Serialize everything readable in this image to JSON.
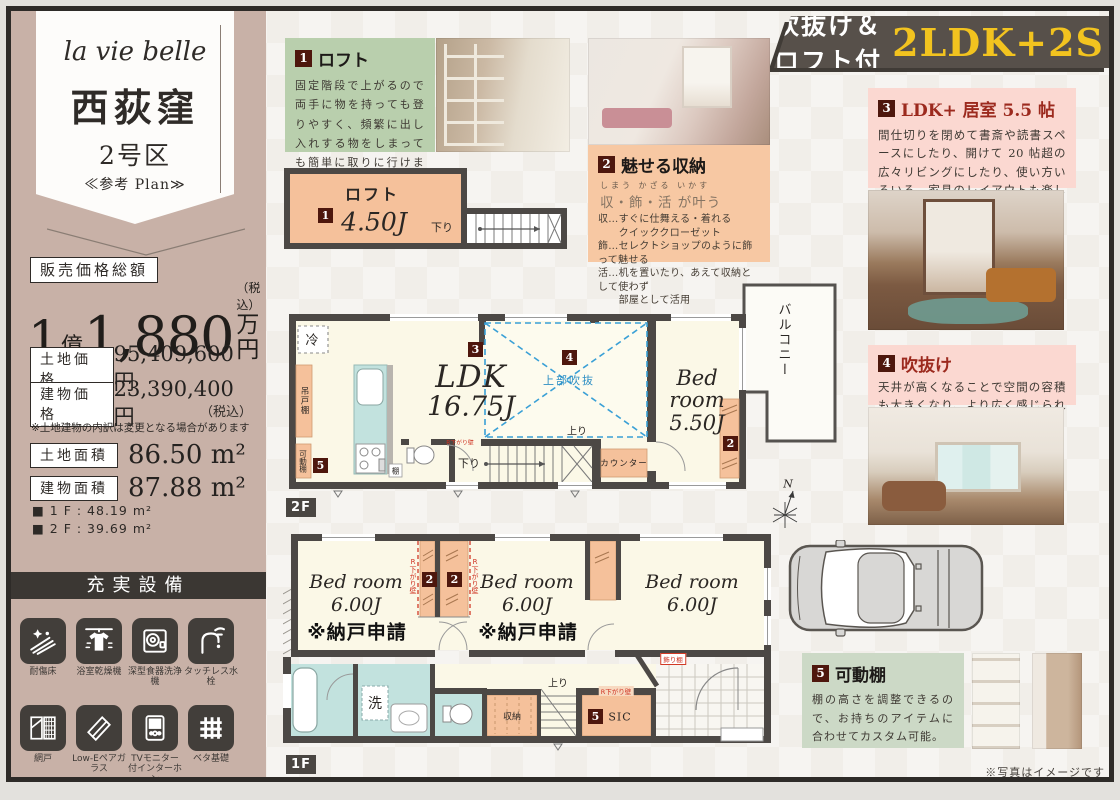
{
  "frame": {
    "disclaimer": "※写真はイメージです"
  },
  "banner": {
    "prefix": "吹抜け＆ロフト付",
    "plan_type": "2LDK+2S"
  },
  "sidebar": {
    "brand": "la vie belle",
    "name": "西荻窪",
    "lot": "2号区",
    "plan_ref": "≪参考 Plan≫",
    "price_label": "販売価格総額",
    "price": {
      "n1": "1",
      "u1": "億",
      "n2": "1,880",
      "tax": "（税込）",
      "u2": "万円"
    },
    "rows": [
      {
        "label": "土地価格",
        "value": "95,409,600 円"
      },
      {
        "label": "建物価格",
        "value": "23,390,400 円",
        "note": "（税込）"
      }
    ],
    "note": "※土地建物の内訳は変更となる場合があります",
    "areas": [
      {
        "label": "土地面積",
        "value": "86.50 m²"
      },
      {
        "label": "建物面積",
        "value": "87.88 m²"
      }
    ],
    "floors": [
      "■ 1 F : 48.19 m²",
      "■ 2 F : 39.69 m²"
    ],
    "equipment_title": "充実設備",
    "equipment": [
      {
        "label": "耐傷床",
        "icon": "scratch-resistant-floor"
      },
      {
        "label": "浴室乾燥機",
        "icon": "bathroom-dryer"
      },
      {
        "label": "深型食器洗浄機",
        "icon": "deep-dishwasher"
      },
      {
        "label": "タッチレス水栓",
        "icon": "touchless-faucet"
      },
      {
        "label": "網戸",
        "icon": "screen-door"
      },
      {
        "label": "Low-Eペアガラス",
        "icon": "low-e-pair-glass"
      },
      {
        "label": "TVモニター付インターホン",
        "icon": "tv-monitor-intercom"
      },
      {
        "label": "ベタ基礎",
        "icon": "slab-foundation"
      }
    ]
  },
  "features": {
    "f1": {
      "num": "1",
      "title": "ロフト",
      "body": "固定階段で上がるので両手に物を持っても登りやすく、頻繁に出し入れする物をしまっても簡単に取りに行けます。"
    },
    "f2": {
      "num": "2",
      "title": "魅せる収納",
      "ruby": "しまう かざる いかす",
      "sub": "収・飾・活 が叶う",
      "lines": [
        "収…すぐに仕舞える・着れる",
        "　　クイッククローゼット",
        "飾…セレクトショップのように飾って魅せる",
        "活…机を置いたり、あえて収納として使わず",
        "　　部屋として活用"
      ]
    },
    "f3": {
      "num": "3",
      "title": "LDK+ 居室 5.5 帖",
      "body": "間仕切りを閉めて書斎や読書スペースにしたり、開けて 20 帖超の広々リビングにしたり、使い方いろいろ。家具のレイアウトも楽しみの一つです。"
    },
    "f4": {
      "num": "4",
      "title": "吹抜け",
      "body": "天井が高くなることで空間の容積も大きくなり、より広く感じられます。"
    },
    "f5": {
      "num": "5",
      "title": "可動棚",
      "body": "棚の高さを調整できるので、お持ちのアイテムに合わせてカスタム可能。"
    }
  },
  "plans": {
    "loft": {
      "badge": "1",
      "name": "ロフト",
      "size": "4.50J",
      "down": "下り"
    },
    "f2": {
      "tag": "2F",
      "badge2": "2",
      "badge3": "3",
      "badge4": "4",
      "badge5": "5",
      "ldk": "LDK",
      "ldk_size": "16.75J",
      "void": "上部吹抜",
      "fridge": "冷",
      "hang_shelf": "吊戸棚",
      "mov_shelf": "可動棚",
      "shelf": "棚",
      "counter": "カウンター",
      "up": "上り",
      "down": "下り",
      "rwall": "R下がり壁",
      "bed_l1": "Bed",
      "bed_l2": "room",
      "bed_size": "5.50J",
      "balcony": "バルコニー"
    },
    "f1": {
      "tag": "1F",
      "badge2a": "2",
      "badge2b": "2",
      "badge5": "5",
      "bed1": "Bed room",
      "bed1_size": "6.00J",
      "bed1_note": "※納戸申請",
      "bed2": "Bed room",
      "bed2_size": "6.00J",
      "bed2_note": "※納戸申請",
      "bed3": "Bed room",
      "bed3_size": "6.00J",
      "rwall_left": "R下がり壁",
      "rwall_right": "R下がり壁",
      "rwall_sic": "R下がり壁",
      "wash": "洗",
      "storage": "収納",
      "sic": "SIC",
      "up": "上り",
      "deco_shelf": "飾り棚"
    },
    "compass": "N"
  }
}
